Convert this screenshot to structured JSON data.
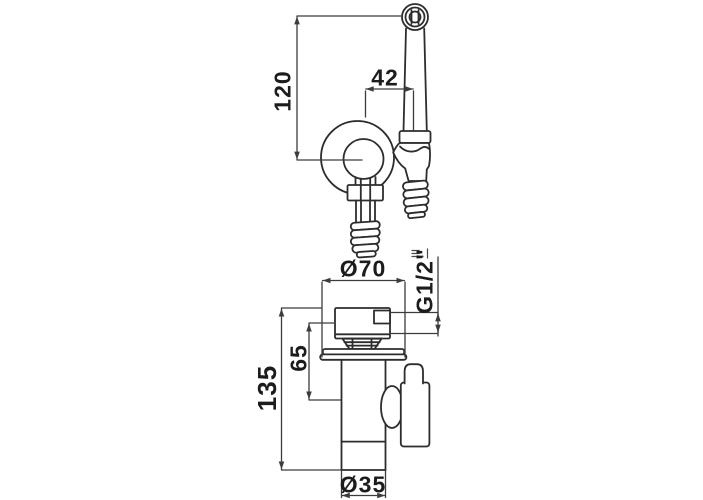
{
  "drawing": {
    "labels": {
      "handle_height": "120",
      "reach_offset": "42",
      "flange_diameter": "Ø70",
      "thread_size": "G1/2\"",
      "outlet_height": "65",
      "body_height": "135",
      "base_diameter": "Ø35"
    },
    "colors": {
      "line": "#2d2d2d",
      "dimension_line": "#3c3c3c",
      "text": "#1c1c1c",
      "background": "#ffffff"
    }
  }
}
